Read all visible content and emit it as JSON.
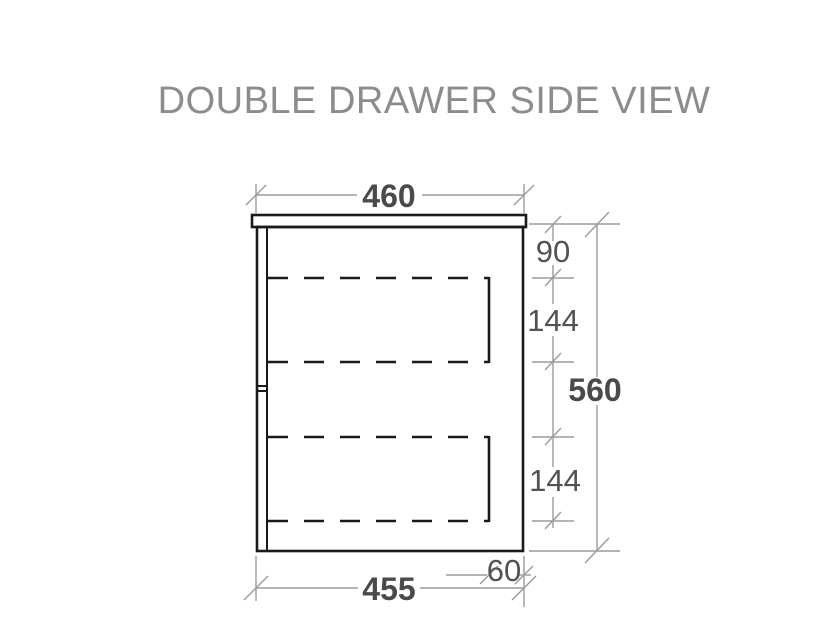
{
  "title": "DOUBLE DRAWER SIDE VIEW",
  "drawing": {
    "type": "technical-elevation",
    "object": "double-drawer-cabinet-side-view",
    "dimensions": {
      "top_width": "460",
      "bottom_width": "455",
      "overall_height": "560",
      "top_to_upper_drawer": "90",
      "upper_drawer_height": "144",
      "lower_drawer_height": "144",
      "rear_gap": "60"
    }
  },
  "colors": {
    "bg": "#ffffff",
    "outline": "#1a1a1a",
    "dim": "#9b9b9b",
    "dimtext": "#4a4a4a",
    "titletext": "#8c8c8c"
  }
}
